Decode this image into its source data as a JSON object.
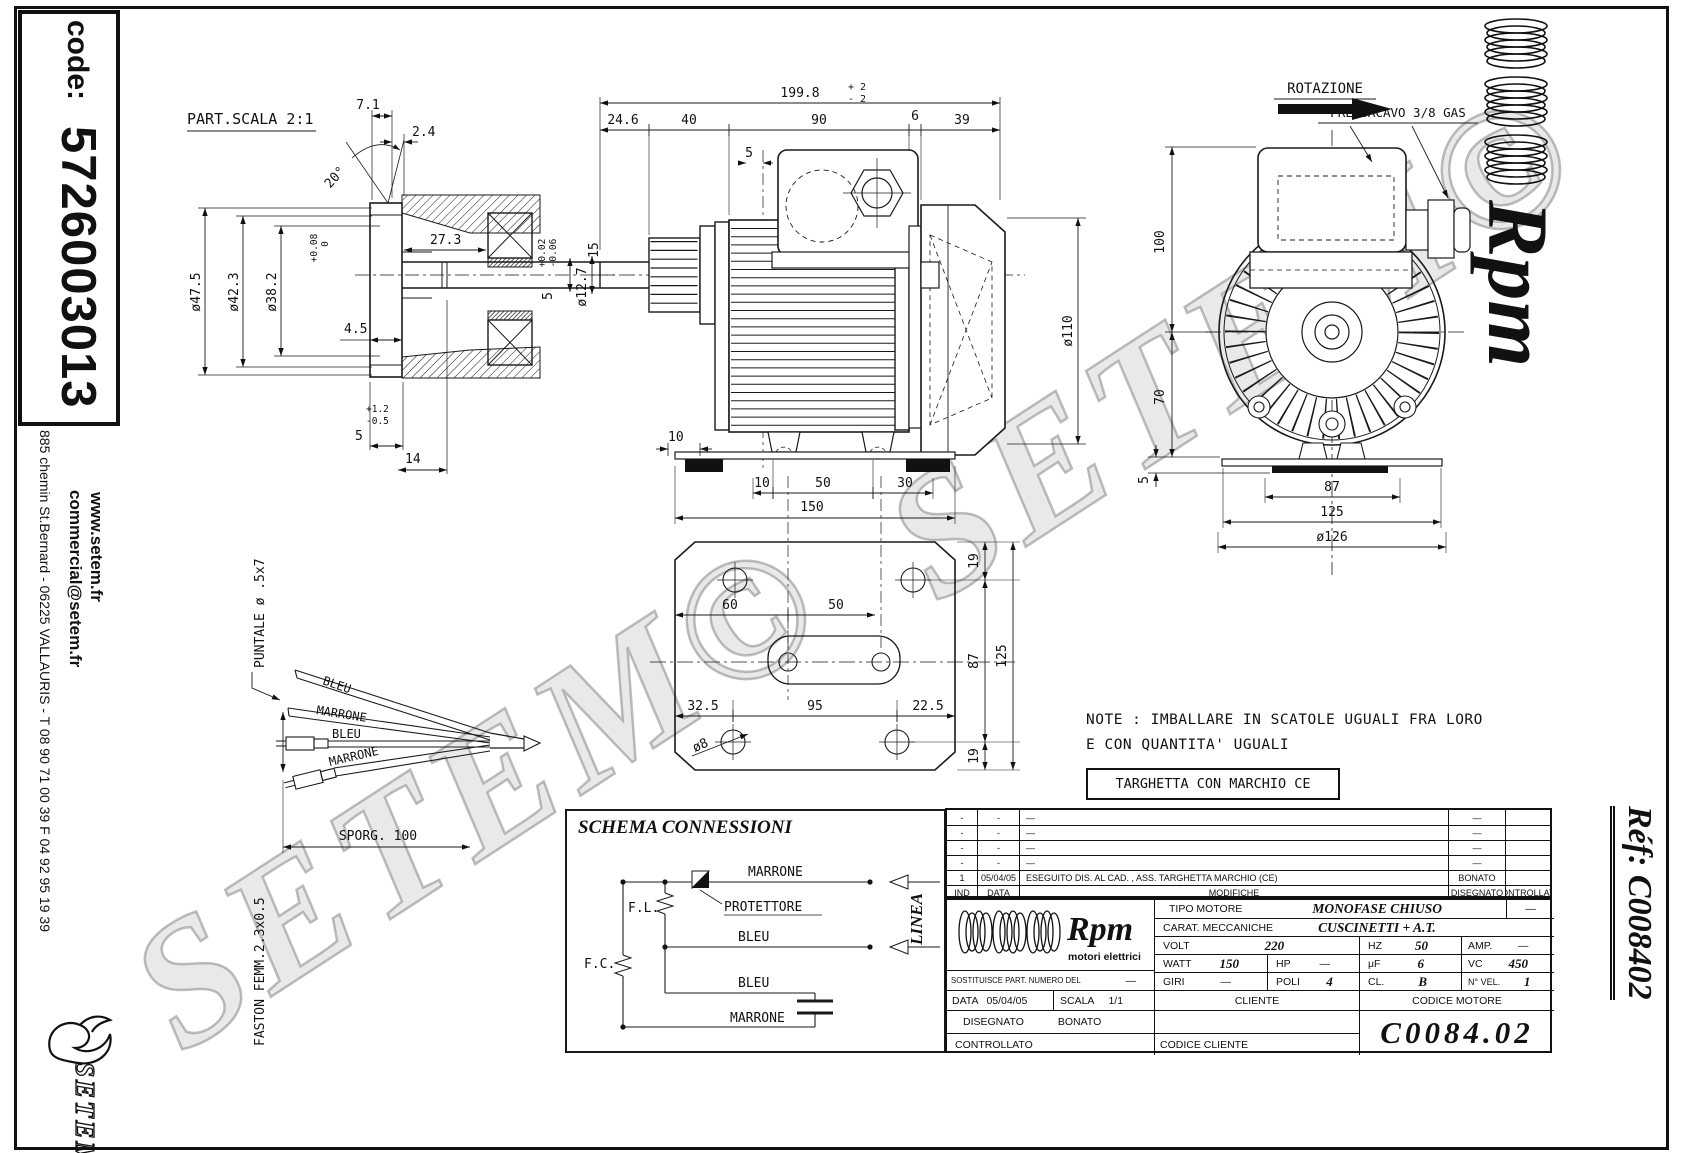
{
  "left_bar": {
    "code_label": "code:",
    "code_value": "5726003013",
    "website": "www.setem.fr",
    "email": "commercial@setem.fr",
    "address": "885 chemin St.Bernard  -  06225 VALLAURIS  -  T 08 90 71 00 39   F 04 92 95 19 39",
    "brand": "SETEM"
  },
  "right_bar": {
    "brand": "Rpm",
    "ref": "Réf:  C008402"
  },
  "watermark": {
    "text": "SETEM©"
  },
  "part_detail": {
    "title": "PART.SCALA 2:1",
    "dims": {
      "thickness": "7.1",
      "step": "2.4",
      "angle": "20°",
      "od": "ø47.5",
      "d2": "ø42.3",
      "d3": "ø38.2",
      "d3_tol_plus": "+0.08",
      "d3_tol_zero": "0",
      "depth": "27.3",
      "d45": "4.5",
      "tol5_plus": "+1.2",
      "tol5_minus": "-0.5",
      "d5": "5",
      "d14": "14",
      "shaft": "ø12.7",
      "shaft_tol_plus": "+0.02",
      "shaft_tol_minus": "-0.06",
      "key5": "5",
      "key15": "15"
    }
  },
  "side_view": {
    "dims": {
      "overall": "199.8",
      "overall_plus": "+ 2",
      "overall_minus": "- 2",
      "c1": "24.6",
      "c2": "40",
      "c3": "90",
      "c4": "6",
      "c5": "39",
      "d5": "5",
      "fan": "ø110",
      "foot10": "10",
      "b10": "10",
      "b50": "50",
      "b30": "30"
    }
  },
  "front_view": {
    "rotation_label": "ROTAZIONE",
    "gland_label": "PRESSACAVO 3/8 GAS",
    "dims": {
      "h100": "100",
      "h70": "70",
      "h5": "5",
      "w87": "87",
      "w125": "125",
      "w126": "ø126"
    }
  },
  "base_plate": {
    "dims": {
      "w150": "150",
      "d60": "60",
      "d50": "50",
      "d325": "32.5",
      "d95": "95",
      "d225": "22.5",
      "hole": "ø8",
      "r19a": "19",
      "r87": "87",
      "r19b": "19",
      "r125": "125"
    }
  },
  "wire_detail": {
    "puntale": "PUNTALE ø .5x7",
    "faston": "FASTON FEMM.2.3x0.5",
    "sporg": "SPORG. 100",
    "wire1": "BLEU",
    "wire2": "MARRONE",
    "wire3": "BLEU",
    "wire4": "MARRONE"
  },
  "schema": {
    "title": "SCHEMA CONNESSIONI",
    "fl": "F.L.",
    "fc": "F.C.",
    "protettore": "PROTETTORE",
    "wire1": "MARRONE",
    "wire2": "BLEU",
    "wire3": "BLEU",
    "wire4": "MARRONE",
    "linea": "LINEA"
  },
  "note": {
    "line1": "NOTE : IMBALLARE IN SCATOLE UGUALI FRA LORO",
    "line2": "E CON QUANTITA' UGUALI"
  },
  "targhetta": {
    "text": "TARGHETTA CON MARCHIO CE"
  },
  "revision_table": {
    "headers": {
      "ind": "IND",
      "data": "DATA",
      "modifiche": "MODIFICHE",
      "disegnato": "DISEGNATO",
      "controllato": "CONTROLLATO"
    },
    "rows": [
      {
        "ind": "-",
        "data": "-",
        "modifiche": "—",
        "disegnato": "—",
        "controllato": ""
      },
      {
        "ind": "-",
        "data": "-",
        "modifiche": "—",
        "disegnato": "—",
        "controllato": ""
      },
      {
        "ind": "-",
        "data": "-",
        "modifiche": "—",
        "disegnato": "—",
        "controllato": ""
      },
      {
        "ind": "-",
        "data": "-",
        "modifiche": "—",
        "disegnato": "—",
        "controllato": ""
      },
      {
        "ind": "1",
        "data": "05/04/05",
        "modifiche": "ESEGUITO DIS. AL CAD. , ASS. TARGHETTA MARCHIO (CE)",
        "disegnato": "BONATO",
        "controllato": ""
      }
    ]
  },
  "title_block": {
    "brand": "Rpm",
    "brand_sub": "motori elettrici",
    "tipo_label": "TIPO MOTORE",
    "tipo_value": "MONOFASE CHIUSO",
    "tipo_extra": "—",
    "carat_label": "CARAT. MECCANICHE",
    "carat_value": "CUSCINETTI + A.T.",
    "volt_label": "VOLT",
    "volt_value": "220",
    "hz_label": "HZ",
    "hz_value": "50",
    "amp_label": "AMP.",
    "amp_value": "—",
    "watt_label": "WATT",
    "watt_value": "150",
    "hp_label": "HP",
    "hp_value": "—",
    "uf_label": "μF",
    "uf_value": "6",
    "vc_label": "VC",
    "vc_value": "450",
    "sost_label": "SOSTITUISCE PART. NUMERO DEL",
    "sost_value": "—",
    "giri_label": "GIRI",
    "giri_value": "—",
    "poli_label": "POLI",
    "poli_value": "4",
    "cl_label": "CL.",
    "cl_value": "B",
    "nvel_label": "N° VEL.",
    "nvel_value": "1",
    "data_label": "DATA",
    "data_value": "05/04/05",
    "scala_label": "SCALA",
    "scala_value": "1/1",
    "cliente_label": "CLIENTE",
    "codice_motore_label": "CODICE MOTORE",
    "disegnato_label": "DISEGNATO",
    "disegnato_value": "BONATO",
    "controllato_label": "CONTROLLATO",
    "codice_cliente_label": "CODICE CLIENTE",
    "codice_motore_value": "C0084.02"
  }
}
